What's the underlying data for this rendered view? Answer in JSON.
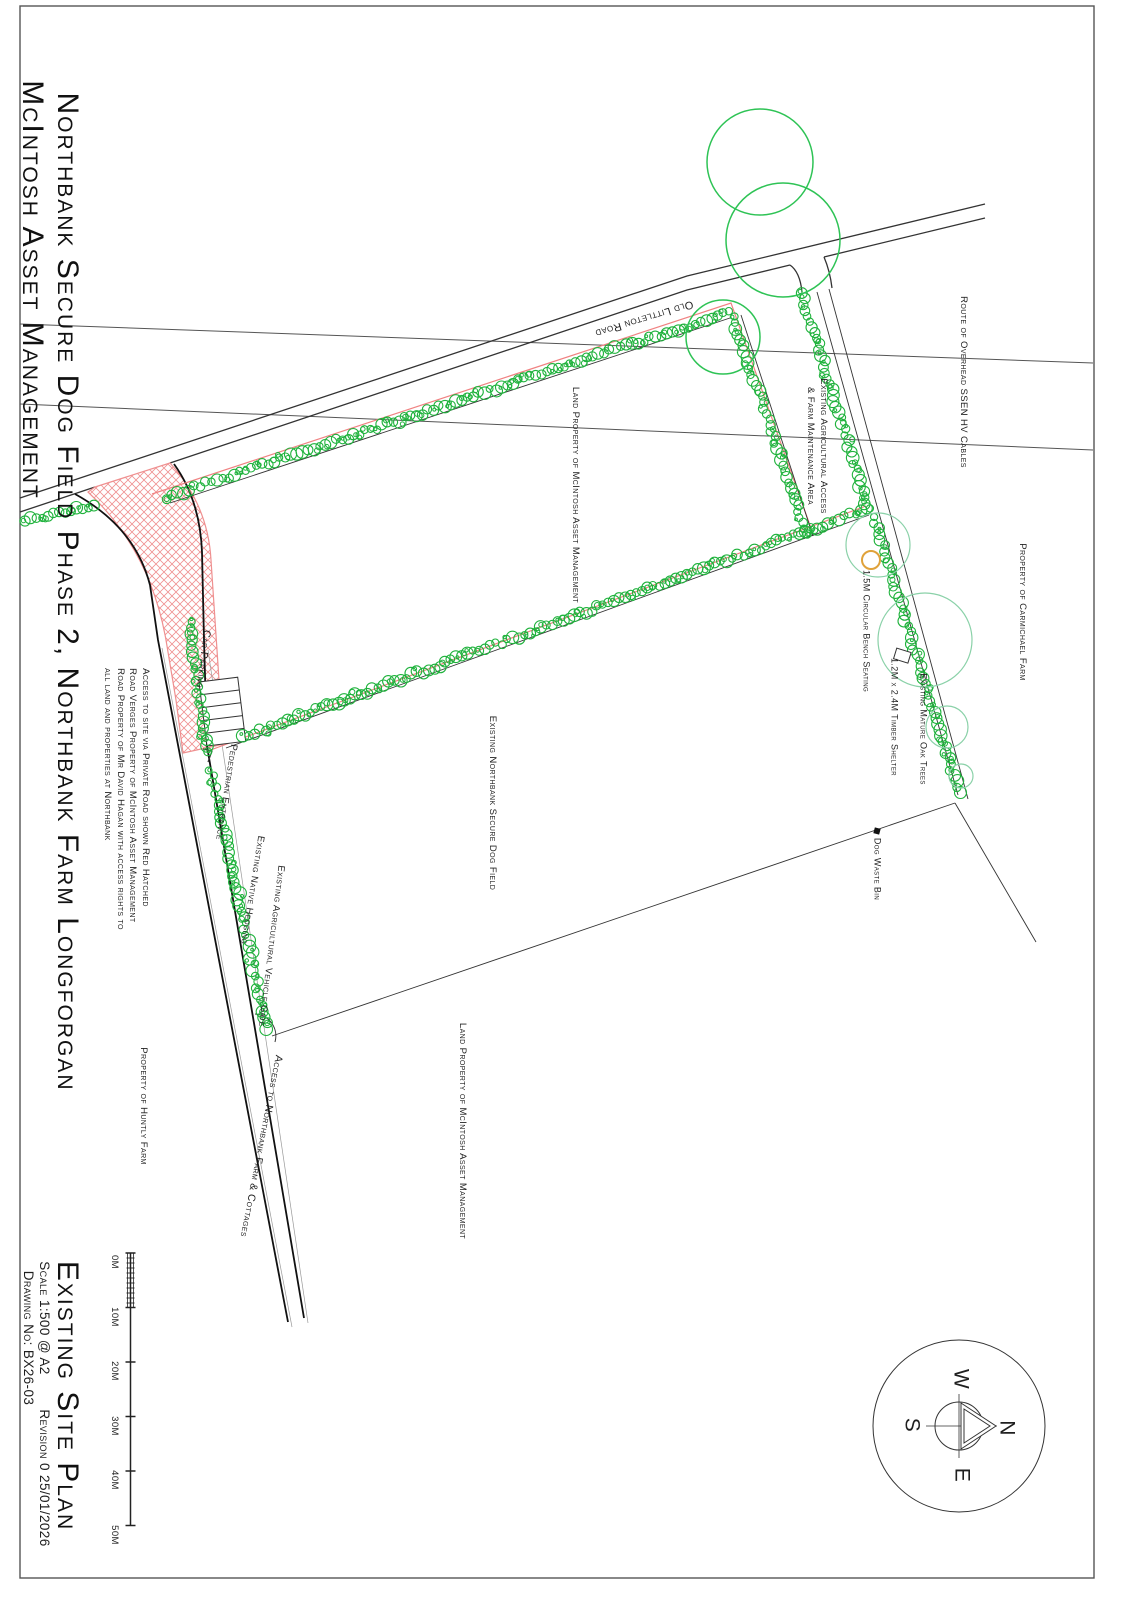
{
  "title_block": {
    "line1": "Northbank Secure Dog Field Phase 2, Northbank Farm Longforgan",
    "line2": "McIntosh Asset Management"
  },
  "footer_block": {
    "plan_title": "Existing Site Plan",
    "scale": "Scale 1:500 @ A2",
    "revision": "Revision 0 25/01/2026",
    "drawing_no": "Drawing No: BX26-03"
  },
  "scale_bar": {
    "labels": [
      "0M",
      "10M",
      "20M",
      "30M",
      "40M",
      "50M"
    ]
  },
  "compass": {
    "n": "N",
    "e": "E",
    "s": "S",
    "w": "W"
  },
  "labels": {
    "road_name": "Old Littleton Road",
    "hv_cables": "Route of Overhead SSEN HV Cables",
    "agri_access_1": "Existing Agricultural Access",
    "agri_access_2": "& Farm Maintenance Area",
    "land_property_upper": "Land Property of McIntosh Asset Management",
    "land_property_lower": "Land Property of McIntosh Asset Management",
    "car_parking": "Car Parking",
    "access_note_1": "Access to site via Private Road shown Red Hatched",
    "access_note_2": "Road Verges Property of McIntosh Asset Management",
    "access_note_3": "Road Property of Mr David Hagan with access rights to",
    "access_note_4": "all land and properties at Northbank",
    "pedestrian_entrance": "Pedestrian Entrance",
    "native_hedging": "Existing Native Hedging",
    "vehicle_gate": "Existing Agricultural Vehicle Gate",
    "access_northbank": "Access to Northbank Farm & Cottages",
    "huntly_farm": "Property of Huntly Farm",
    "dog_field": "Existing Northbank Secure Dog Field",
    "dog_waste_bin": "Dog Waste Bin",
    "bench": "1.5M Circular Bench Seating",
    "shelter": "1.2M x 2.4M Timber Shelter",
    "oak_trees": "Existing Mature Oak Trees",
    "carmichael_farm": "Property of Carmichael Farm"
  },
  "colors": {
    "hedge_green": "#1fb23c",
    "tree_green": "#2ec355",
    "oak_pale_green": "#8ad1a8",
    "boundary_red": "#f08282",
    "hatch_red": "#ef9090",
    "bench_orange": "#e0a23a",
    "line_dark": "#333333",
    "border_grey": "#555555"
  }
}
